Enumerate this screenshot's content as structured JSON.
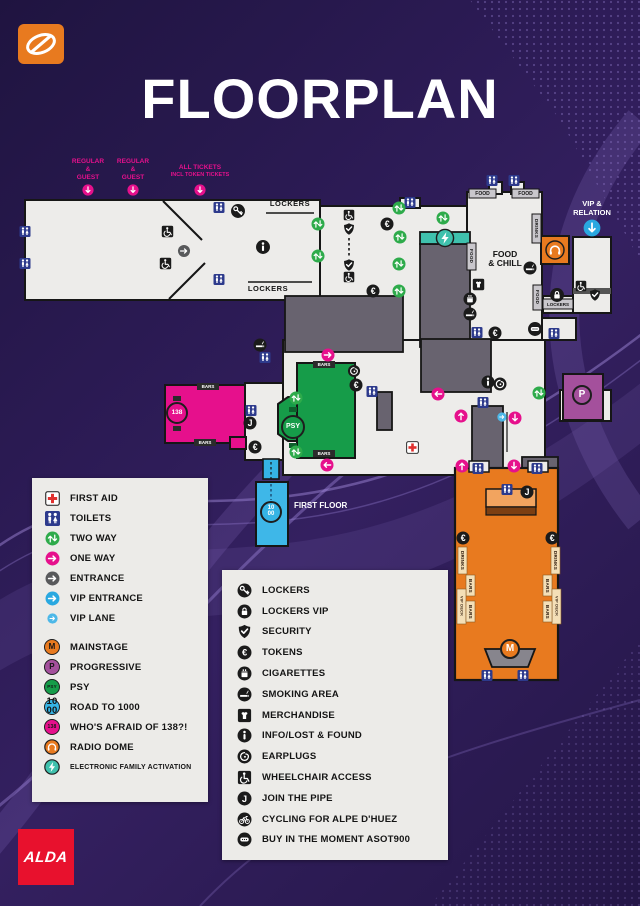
{
  "header": {
    "title": "FLOORPLAN"
  },
  "brand": {
    "alda": "ALDA",
    "asot_logo": "a-state-of-trance-swoosh"
  },
  "entry_labels": {
    "gate1": {
      "l1": "REGULAR",
      "l2": "&",
      "l3": "GUEST"
    },
    "gate2": {
      "l1": "REGULAR",
      "l2": "&",
      "l3": "GUEST"
    },
    "gate3": {
      "l1": "ALL TICKETS",
      "l2": "INCL TOKEN TICKETS"
    }
  },
  "map": {
    "labels": {
      "lockers": "LOCKERS",
      "food": "FOOD",
      "drinks": "DRINKS",
      "bars": "BARS",
      "vip_deck": "VIP DECK",
      "food_chill_1": "FOOD",
      "food_chill_2": "& CHILL",
      "vip_relation_1": "VIP &",
      "vip_relation_2": "RELATION",
      "first_floor": "FIRST FLOOR"
    },
    "badges": {
      "mainstage": "M",
      "progressive": "P",
      "psy": "PSY",
      "road1000_top": "10",
      "road1000_bottom": "00",
      "afraid138": "138"
    }
  },
  "legend_left": {
    "items": [
      {
        "icon": "first-aid-icon",
        "label": "FIRST AID"
      },
      {
        "icon": "toilets-icon",
        "label": "TOILETS"
      },
      {
        "icon": "two-way-icon",
        "label": "TWO WAY"
      },
      {
        "icon": "one-way-icon",
        "label": "ONE WAY"
      },
      {
        "icon": "entrance-icon",
        "label": "ENTRANCE"
      },
      {
        "icon": "vip-entrance-icon",
        "label": "VIP ENTRANCE"
      },
      {
        "icon": "vip-lane-icon",
        "label": "VIP LANE"
      },
      {
        "icon": "mainstage-badge",
        "badge": "M",
        "color": "#e87a1f",
        "label": "MAINSTAGE"
      },
      {
        "icon": "progressive-badge",
        "badge": "P",
        "color": "#a4509c",
        "label": "PROGRESSIVE"
      },
      {
        "icon": "psy-badge",
        "badge": "PSY",
        "color": "#169c49",
        "label": "PSY"
      },
      {
        "icon": "road-to-1000-badge",
        "badge": "10 00",
        "color": "#35b4e5",
        "label": "ROAD TO 1000"
      },
      {
        "icon": "afraid-138-badge",
        "badge": "138",
        "color": "#e6108c",
        "label": "WHO'S AFRAID OF 138?!"
      },
      {
        "icon": "radio-dome-icon",
        "color": "#e87a1f",
        "label": "RADIO DOME"
      },
      {
        "icon": "electronic-family-icon",
        "color": "#3fc1ad",
        "label": "ELECTRONIC FAMILY ACTIVATION"
      }
    ]
  },
  "legend_right": {
    "items": [
      {
        "icon": "lockers-icon",
        "label": "LOCKERS"
      },
      {
        "icon": "lockers-vip-icon",
        "label": "LOCKERS VIP"
      },
      {
        "icon": "security-icon",
        "label": "SECURITY"
      },
      {
        "icon": "tokens-icon",
        "label": "TOKENS"
      },
      {
        "icon": "cigarettes-icon",
        "label": "CIGARETTES"
      },
      {
        "icon": "smoking-area-icon",
        "label": "SMOKING AREA"
      },
      {
        "icon": "merchandise-icon",
        "label": "MERCHANDISE"
      },
      {
        "icon": "info-icon",
        "label": "INFO/LOST & FOUND"
      },
      {
        "icon": "earplugs-icon",
        "label": "EARPLUGS"
      },
      {
        "icon": "wheelchair-icon",
        "label": "WHEELCHAIR ACCESS"
      },
      {
        "icon": "join-the-pipe-icon",
        "label": "JOIN THE PIPE"
      },
      {
        "icon": "cycling-icon",
        "label": "CYCLING FOR ALPE D'HUEZ"
      },
      {
        "icon": "buy-moment-icon",
        "label": "BUY IN THE MOMENT ASOT900"
      }
    ]
  },
  "colors": {
    "background": "#2c1b55",
    "map_fill": "#edecea",
    "outline": "#1a1a1a",
    "one_way_pink": "#e6108c",
    "two_way_green": "#2eab4b",
    "entrance_gray": "#58595b",
    "vip_blue": "#29a8e0",
    "toilets_blue": "#2d3a8c",
    "mainstage_orange": "#e87a1f",
    "progressive_purple": "#a4509c",
    "psy_green": "#169c49",
    "road1000_blue": "#35b4e5",
    "afraid138_pink": "#e6108c",
    "efa_teal": "#3fc1ad",
    "alda_red": "#e8112d",
    "first_aid_red": "#e0312f"
  }
}
